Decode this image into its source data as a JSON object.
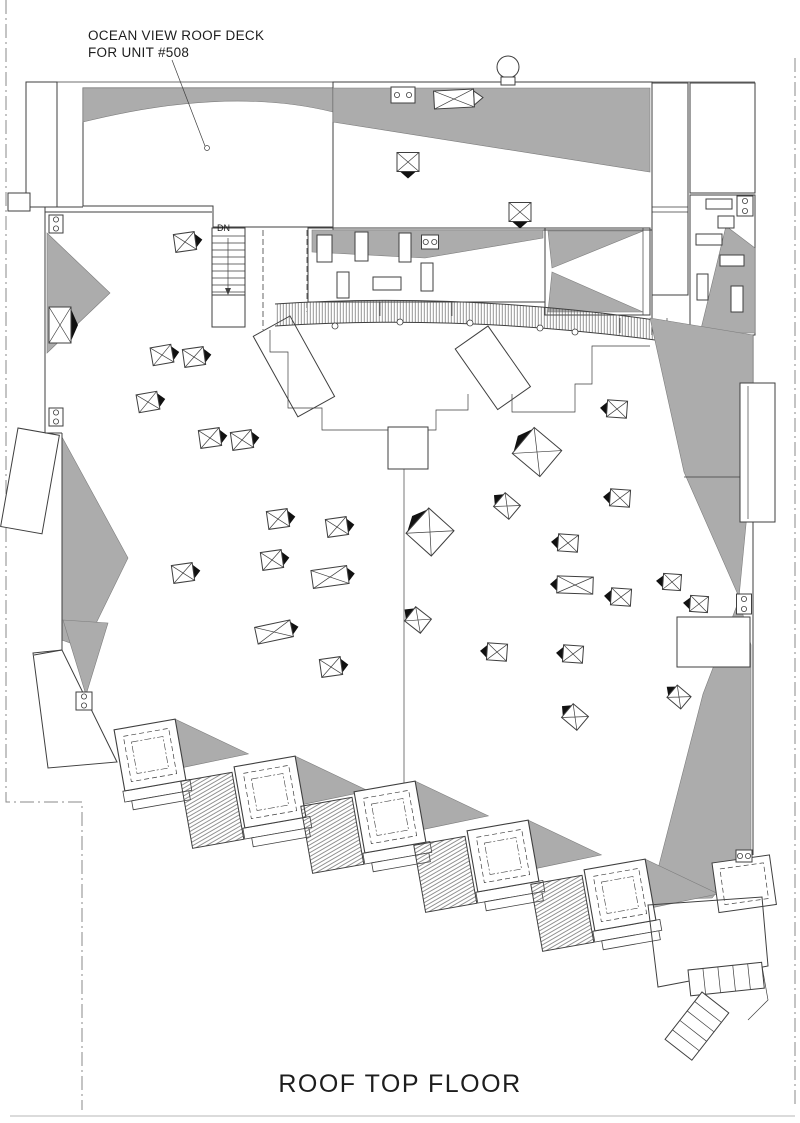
{
  "drawing": {
    "title": "ROOF TOP FLOOR",
    "callout": {
      "line1": "OCEAN VIEW ROOF DECK",
      "line2": "FOR UNIT #508"
    },
    "stair_label": "DN",
    "colors": {
      "roof_gray": "#acacac",
      "ink": "#3f3f3f",
      "hatch_bg": "#f6f3ec",
      "shadow": "#111111",
      "property_line": "#8a8a8a"
    },
    "skylights": [
      {
        "x": 408,
        "y": 162,
        "w": 22,
        "h": 19,
        "rot": 0,
        "shadow": "bottom"
      },
      {
        "x": 520,
        "y": 212,
        "w": 22,
        "h": 19,
        "rot": 0,
        "shadow": "bottom"
      },
      {
        "x": 185,
        "y": 242,
        "w": 21,
        "h": 18,
        "rot": -8,
        "shadow": "right"
      },
      {
        "x": 60,
        "y": 325,
        "w": 22,
        "h": 36,
        "rot": 0,
        "shadow": "right"
      },
      {
        "x": 162,
        "y": 355,
        "w": 21,
        "h": 18,
        "rot": -10,
        "shadow": "right"
      },
      {
        "x": 194,
        "y": 357,
        "w": 21,
        "h": 18,
        "rot": -8,
        "shadow": "right"
      },
      {
        "x": 148,
        "y": 402,
        "w": 21,
        "h": 18,
        "rot": -10,
        "shadow": "right"
      },
      {
        "x": 210,
        "y": 438,
        "w": 21,
        "h": 18,
        "rot": -8,
        "shadow": "right"
      },
      {
        "x": 242,
        "y": 440,
        "w": 21,
        "h": 18,
        "rot": -8,
        "shadow": "right"
      },
      {
        "x": 278,
        "y": 519,
        "w": 21,
        "h": 18,
        "rot": -8,
        "shadow": "right"
      },
      {
        "x": 337,
        "y": 527,
        "w": 21,
        "h": 18,
        "rot": -8,
        "shadow": "right"
      },
      {
        "x": 272,
        "y": 560,
        "w": 21,
        "h": 18,
        "rot": -8,
        "shadow": "right"
      },
      {
        "x": 330,
        "y": 577,
        "w": 36,
        "h": 18,
        "rot": -8,
        "shadow": "right"
      },
      {
        "x": 183,
        "y": 573,
        "w": 21,
        "h": 18,
        "rot": -8,
        "shadow": "right"
      },
      {
        "x": 274,
        "y": 632,
        "w": 36,
        "h": 17,
        "rot": -12,
        "shadow": "right"
      },
      {
        "x": 331,
        "y": 667,
        "w": 21,
        "h": 18,
        "rot": -8,
        "shadow": "right"
      },
      {
        "x": 430,
        "y": 532,
        "w": 34,
        "h": 34,
        "rot": 42,
        "shadow": "left"
      },
      {
        "x": 418,
        "y": 620,
        "w": 20,
        "h": 18,
        "rot": 38,
        "shadow": "left"
      },
      {
        "x": 617,
        "y": 409,
        "w": 20,
        "h": 17,
        "rot": 4,
        "shadow": "left"
      },
      {
        "x": 537,
        "y": 452,
        "w": 36,
        "h": 34,
        "rot": 40,
        "shadow": "left"
      },
      {
        "x": 507,
        "y": 506,
        "w": 20,
        "h": 18,
        "rot": 40,
        "shadow": "left"
      },
      {
        "x": 620,
        "y": 498,
        "w": 20,
        "h": 17,
        "rot": 4,
        "shadow": "left"
      },
      {
        "x": 568,
        "y": 543,
        "w": 20,
        "h": 17,
        "rot": 4,
        "shadow": "left"
      },
      {
        "x": 575,
        "y": 585,
        "w": 36,
        "h": 17,
        "rot": 2,
        "shadow": "left"
      },
      {
        "x": 621,
        "y": 597,
        "w": 20,
        "h": 17,
        "rot": 4,
        "shadow": "left"
      },
      {
        "x": 672,
        "y": 582,
        "w": 18,
        "h": 16,
        "rot": 4,
        "shadow": "left"
      },
      {
        "x": 699,
        "y": 604,
        "w": 18,
        "h": 16,
        "rot": 4,
        "shadow": "left"
      },
      {
        "x": 497,
        "y": 652,
        "w": 20,
        "h": 17,
        "rot": 4,
        "shadow": "left"
      },
      {
        "x": 573,
        "y": 654,
        "w": 20,
        "h": 17,
        "rot": 4,
        "shadow": "left"
      },
      {
        "x": 679,
        "y": 697,
        "w": 18,
        "h": 16,
        "rot": 40,
        "shadow": "left"
      },
      {
        "x": 575,
        "y": 717,
        "w": 20,
        "h": 18,
        "rot": 40,
        "shadow": "left"
      }
    ],
    "equipment_units": [
      {
        "x": 403,
        "y": 95,
        "w": 24,
        "h": 16
      },
      {
        "x": 56,
        "y": 224,
        "w": 14,
        "h": 18
      },
      {
        "x": 745,
        "y": 206,
        "w": 16,
        "h": 20
      },
      {
        "x": 430,
        "y": 242,
        "w": 17,
        "h": 14
      },
      {
        "x": 56,
        "y": 417,
        "w": 14,
        "h": 18
      },
      {
        "x": 744,
        "y": 604,
        "w": 15,
        "h": 20
      },
      {
        "x": 84,
        "y": 701,
        "w": 16,
        "h": 18
      },
      {
        "x": 744,
        "y": 856,
        "w": 16,
        "h": 12
      }
    ],
    "sawtooth": {
      "rotation": -10,
      "units": [
        {
          "x": 150,
          "y": 755,
          "deck": false
        },
        {
          "x": 270,
          "y": 792,
          "deck": true
        },
        {
          "x": 390,
          "y": 817,
          "deck": true
        },
        {
          "x": 503,
          "y": 856,
          "deck": true
        },
        {
          "x": 620,
          "y": 895,
          "deck": true
        }
      ]
    },
    "band_posts": [
      {
        "x": 335,
        "y": 326
      },
      {
        "x": 400,
        "y": 322
      },
      {
        "x": 470,
        "y": 323
      },
      {
        "x": 540,
        "y": 328
      },
      {
        "x": 575,
        "y": 332
      }
    ]
  }
}
